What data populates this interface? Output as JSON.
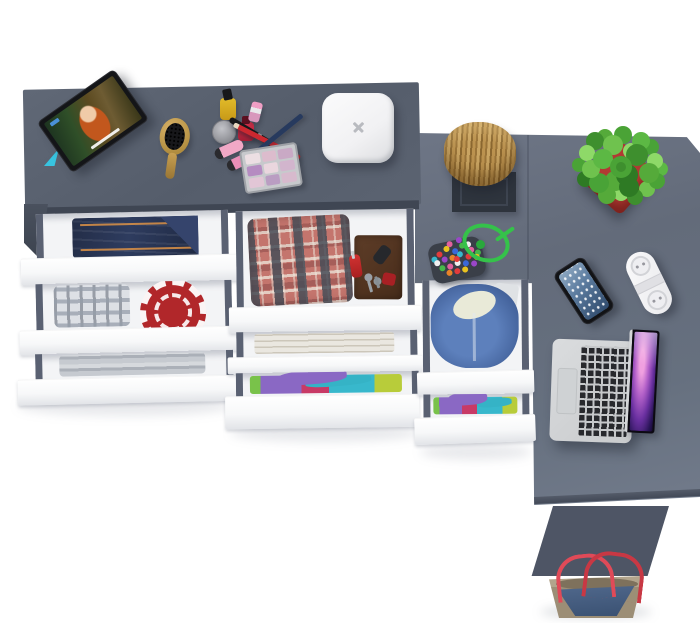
{
  "scene": {
    "title": "Top-down 3D render of a gray L-shaped desk and dresser with open drawers",
    "background": "#ffffff",
    "palette": {
      "dresser_top": "#59616f",
      "desk_top": "#67707f",
      "furniture_front_edge": "#3f4653",
      "drawer_front": "#fbfcfd",
      "drawer_interior": "#f3f4f6",
      "drawer_rail": "#5a6172",
      "side_panel": "#4e5565",
      "pot_red": "#b23a33",
      "plant_green": "#4aa336",
      "knit_red": "#b1272a",
      "hoodie_blue": "#44639c",
      "denim_blue": "#2c3a5c",
      "wood_tan": "#b08a4a",
      "bag_handle_red": "#d84252",
      "cord_green": "#35c24a",
      "stand_cyan": "#38c4e0"
    },
    "items": {
      "dresser_top_items": [
        "tablet on cyan stand playing an animated movie",
        "wooden hairbrush",
        "yellow nail polish with black cap",
        "red nail polish",
        "pink lipstick",
        "gray cream jar",
        "two pink makeup tubes",
        "red pencil",
        "navy pencil",
        "black makeup brush",
        "eyeshadow palette with 9 pink-purple pans",
        "white rounded wireless charger with x logo"
      ],
      "desk_top_items": [
        "wooden log decor on black stand",
        "green plant in red square pot",
        "multicolor beaded pouch with green cord",
        "smartphone",
        "white power strip with two sockets",
        "open silver laptop with purple galaxy wallpaper"
      ],
      "left_drawers": [
        "folded dark blue jeans",
        "gray plaid shirt and red knit doily",
        "gray folded towels"
      ],
      "middle_drawers": [
        "red plaid shorts with brown leather organizer, pocket knife, keys and key fob",
        "white folded towels",
        "colorful folded clothes (purple, teal, pink, green)"
      ],
      "right_drawers": [
        "blue hoodie with cream lining",
        "colorful folded clothes"
      ],
      "floor_items": [
        "blue denim tote bag with tan trim and red handles"
      ]
    }
  }
}
